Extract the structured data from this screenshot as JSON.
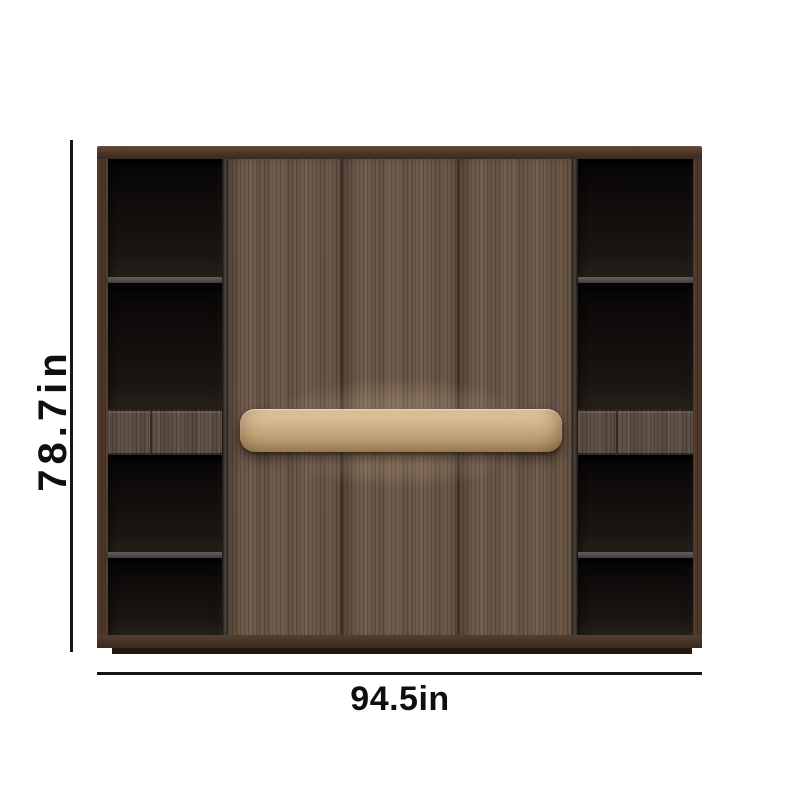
{
  "diagram": {
    "type": "product-dimension-diagram",
    "subject": "wood cabinet with open side shelves, three center doors and tan handle bar"
  },
  "dimensions": {
    "height": {
      "label": "78.7in"
    },
    "width": {
      "label": "94.5in"
    }
  },
  "structure": {
    "side_columns": 2,
    "open_shelves_per_column": 4,
    "drawer_fronts_per_column": 1,
    "center_door_panels": 3,
    "handles": 1
  },
  "colors": {
    "background": "#ffffff",
    "frame_wood": "#4e3628",
    "door_wood": "#6f5b4c",
    "drawer_wood": "#5e5046",
    "shelf_interior": "#14100d",
    "shelf_divider": "#55504b",
    "handle_tan": "#c9ab83",
    "plinth": "#231913",
    "dimension_line": "#161616",
    "dimension_text": "#0f0f0f"
  }
}
